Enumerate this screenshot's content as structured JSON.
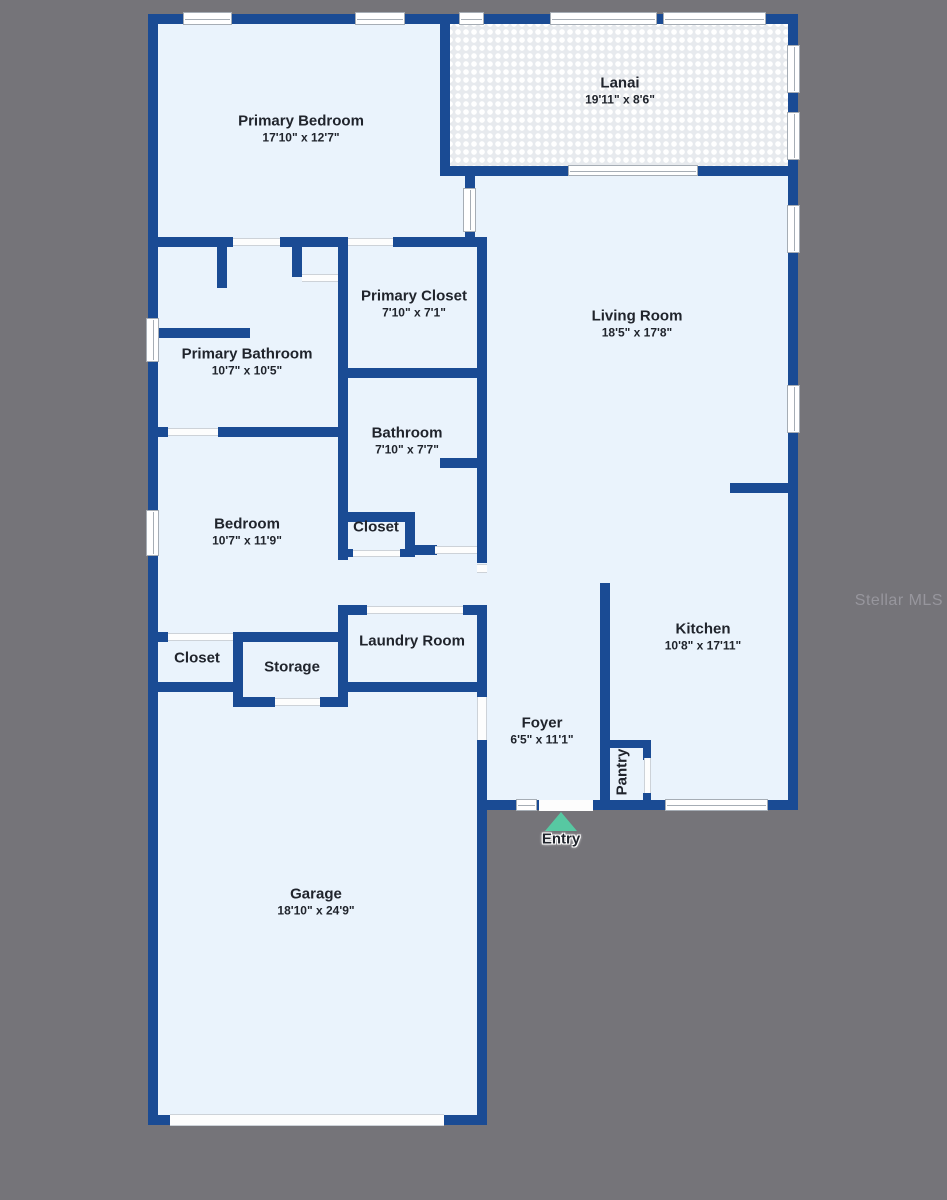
{
  "colors": {
    "wall": "#1a4b94",
    "floor": "#eaf3fc",
    "background": "#757479",
    "entry_marker": "#57c8a2"
  },
  "watermark": "Stellar MLS",
  "rooms": {
    "primary_bedroom": {
      "name": "Primary Bedroom",
      "dims": "17'10\" x 12'7\""
    },
    "lanai": {
      "name": "Lanai",
      "dims": "19'11\" x 8'6\""
    },
    "living_room": {
      "name": "Living Room",
      "dims": "18'5\" x 17'8\""
    },
    "primary_closet": {
      "name": "Primary Closet",
      "dims": "7'10\" x 7'1\""
    },
    "primary_bathroom": {
      "name": "Primary Bathroom",
      "dims": "10'7\" x 10'5\""
    },
    "bathroom": {
      "name": "Bathroom",
      "dims": "7'10\" x 7'7\""
    },
    "bedroom": {
      "name": "Bedroom",
      "dims": "10'7\" x 11'9\""
    },
    "kitchen": {
      "name": "Kitchen",
      "dims": "10'8\" x 17'11\""
    },
    "foyer": {
      "name": "Foyer",
      "dims": "6'5\" x 11'1\""
    },
    "garage": {
      "name": "Garage",
      "dims": "18'10\" x 24'9\""
    },
    "closet_bath": {
      "name": "Closet"
    },
    "closet_hall": {
      "name": "Closet"
    },
    "storage": {
      "name": "Storage"
    },
    "laundry": {
      "name": "Laundry Room"
    },
    "pantry": {
      "name": "Pantry"
    }
  },
  "entry": {
    "label": "Entry"
  }
}
